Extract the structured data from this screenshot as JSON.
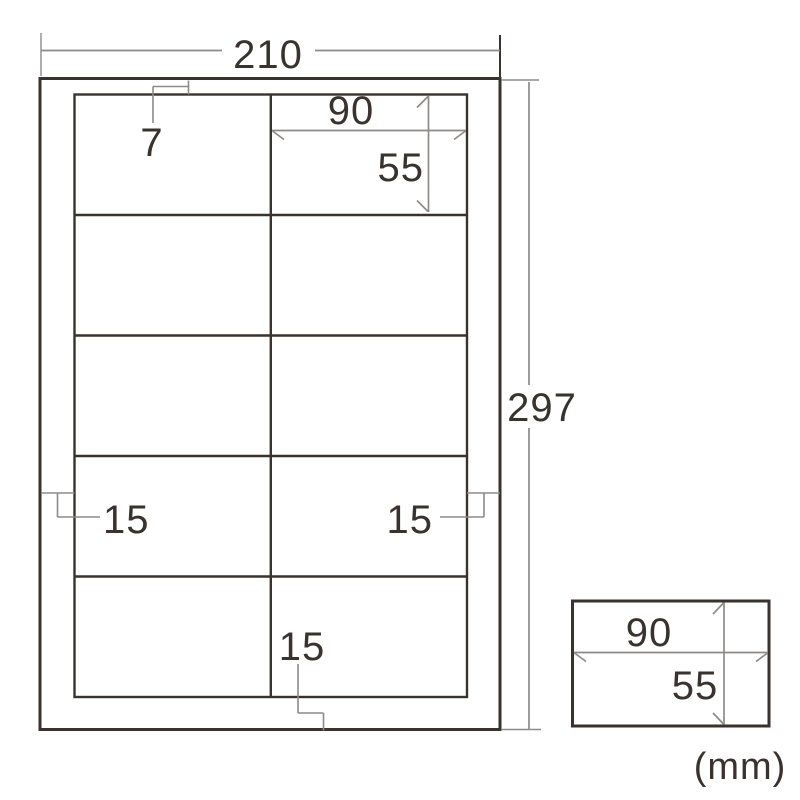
{
  "diagram": {
    "unit_label": "(mm)",
    "sheet": {
      "width_mm": "210",
      "height_mm": "297",
      "top_margin_mm": "7",
      "left_margin_mm": "15",
      "right_margin_mm": "15",
      "bottom_margin_mm": "15"
    },
    "cell": {
      "width_mm": "90",
      "height_mm": "55"
    },
    "single_label": {
      "width_mm": "90",
      "height_mm": "55"
    },
    "grid": {
      "columns": 2,
      "rows": 5
    }
  },
  "colors": {
    "outline_dark": "#3a322f",
    "dimension_gray": "#8e8a88",
    "background": "#ffffff"
  }
}
